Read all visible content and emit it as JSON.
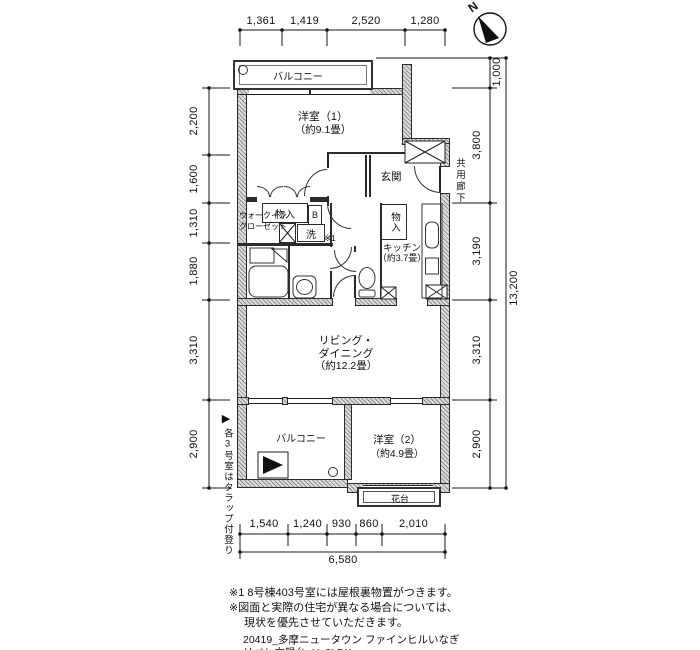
{
  "compass": {
    "north_label": "N"
  },
  "dimensions": {
    "top": [
      "1,361",
      "1,419",
      "2,520",
      "1,280"
    ],
    "left": [
      "2,200",
      "1,600",
      "1,310",
      "1,880",
      "3,310",
      "2,900"
    ],
    "right": [
      "1,000",
      "3,800",
      "3,190",
      "3,310",
      "2,900"
    ],
    "right_total": "13,200",
    "bottom": [
      "1,540",
      "1,240",
      "930",
      "860",
      "2,010"
    ],
    "bottom_total": "6,580"
  },
  "rooms": {
    "balcony_top": "バルコニー",
    "bedroom1": "洋室（1）",
    "bedroom1_size": "（約9.1畳）",
    "entrance": "玄関",
    "wic_line1": "ウォークイン",
    "wic_line2": "クローゼット",
    "storage1": "物入",
    "water_heater": "B",
    "wash": "洗",
    "note_ref": "※1",
    "storage2": "物入",
    "kitchen": "キッチン",
    "kitchen_size": "（約3.7畳）",
    "living_line1": "リビング・",
    "living_line2": "ダイニング",
    "living_size": "（約12.2畳）",
    "balcony_bottom": "バルコニー",
    "bedroom2": "洋室（2）",
    "bedroom2_size": "（約4.9畳）",
    "flower_stand": "花台",
    "corridor": "共用廊下"
  },
  "side_note": {
    "marker": "▶",
    "text": "各3号室はタラップ付登り"
  },
  "notes": {
    "line1": "※1 8号棟403号室には屋根裏物置がつきます。",
    "line2": "※図面と実際の住宅が異なる場合については、",
    "line3": "現状を優先させていただきます。"
  },
  "footer": {
    "line1": "20419_多摩ニュータウン ファインヒルいなぎ",
    "line2": "リベレ向陽台_U_2LDK"
  },
  "colors": {
    "line": "#1a1a1a",
    "wall_hatch": "#8f8f8f"
  }
}
